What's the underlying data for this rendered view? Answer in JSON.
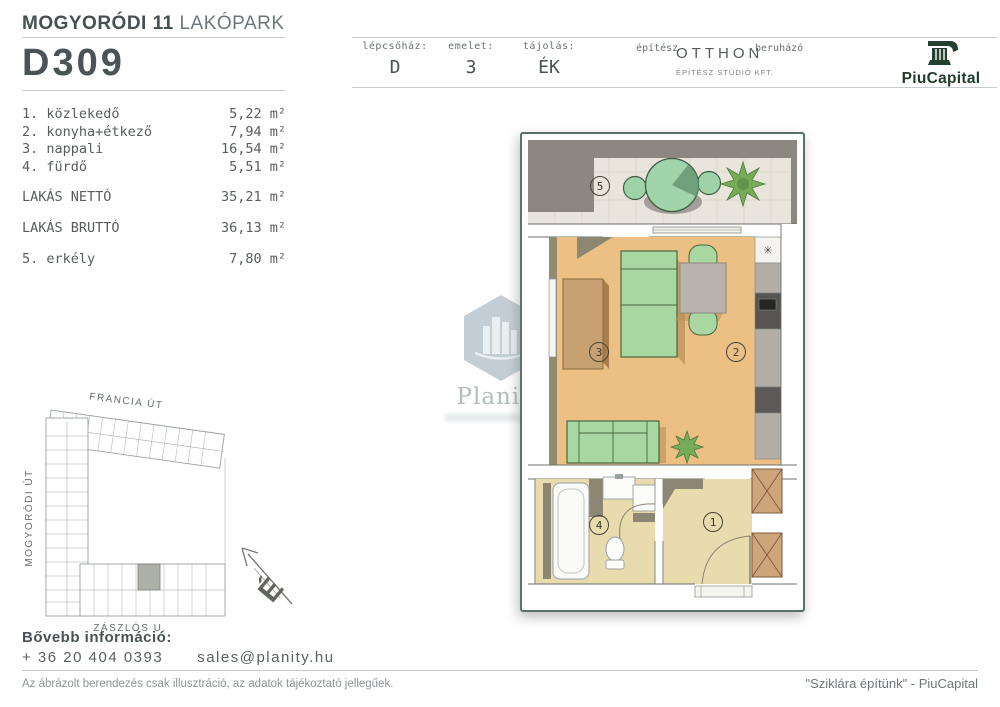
{
  "header": {
    "project_bold": "MOGYORÓDI 11",
    "project_light": "LAKÓPARK",
    "unit_code": "D309"
  },
  "info_bar": {
    "staircase": {
      "label": "lépcsőház:",
      "value": "D"
    },
    "floor": {
      "label": "emelet:",
      "value": "3"
    },
    "orientation": {
      "label": "tájolás:",
      "value": "ÉK"
    },
    "architect": {
      "label": "építész",
      "name": "OTTHON",
      "subtitle": "ÉPÍTÉSZ STÚDIÓ KFT."
    },
    "developer": {
      "label": "beruházó",
      "name": "PiuCapital"
    }
  },
  "room_list": {
    "unit": "m²",
    "items": [
      {
        "label": "1. közlekedő",
        "area": "5,22"
      },
      {
        "label": "2. konyha+étkező",
        "area": "7,94"
      },
      {
        "label": "3. nappali",
        "area": "16,54"
      },
      {
        "label": "4. fürdő",
        "area": "5,51"
      }
    ],
    "net": {
      "label": "LAKÁS NETTÓ",
      "area": "35,21"
    },
    "gross": {
      "label": "LAKÁS BRUTTÓ",
      "area": "36,13"
    },
    "balcony": {
      "label": "5. erkély",
      "area": "7,80"
    }
  },
  "floor_plan": {
    "markers": {
      "hall": "1",
      "kitchen": "2",
      "living": "3",
      "bath": "4",
      "balcony": "5"
    },
    "hob_symbol": "✳"
  },
  "site_map": {
    "street_top": "FRANCIA ÚT",
    "street_left": "MOGYORÓDI ÚT",
    "street_bottom": "ZÁSZLÓS U.",
    "compass_letter": "É"
  },
  "watermark": {
    "brand": "Planity"
  },
  "footer": {
    "more_info": "Bővebb információ:",
    "phone": "+ 36 20 404 0393",
    "email": "sales@planity.hu",
    "disclaimer": "Az ábrázolt berendezés csak illusztráció, az adatok tájékoztató jellegűek.",
    "slogan": "\"Sziklára építünk\" - PiuCapital"
  },
  "colors": {
    "brand_green": "#223c2c",
    "floor_wood": "#ecbf85",
    "floor_tile": "#e8dbae",
    "furniture_green": "#a8d7a2"
  }
}
